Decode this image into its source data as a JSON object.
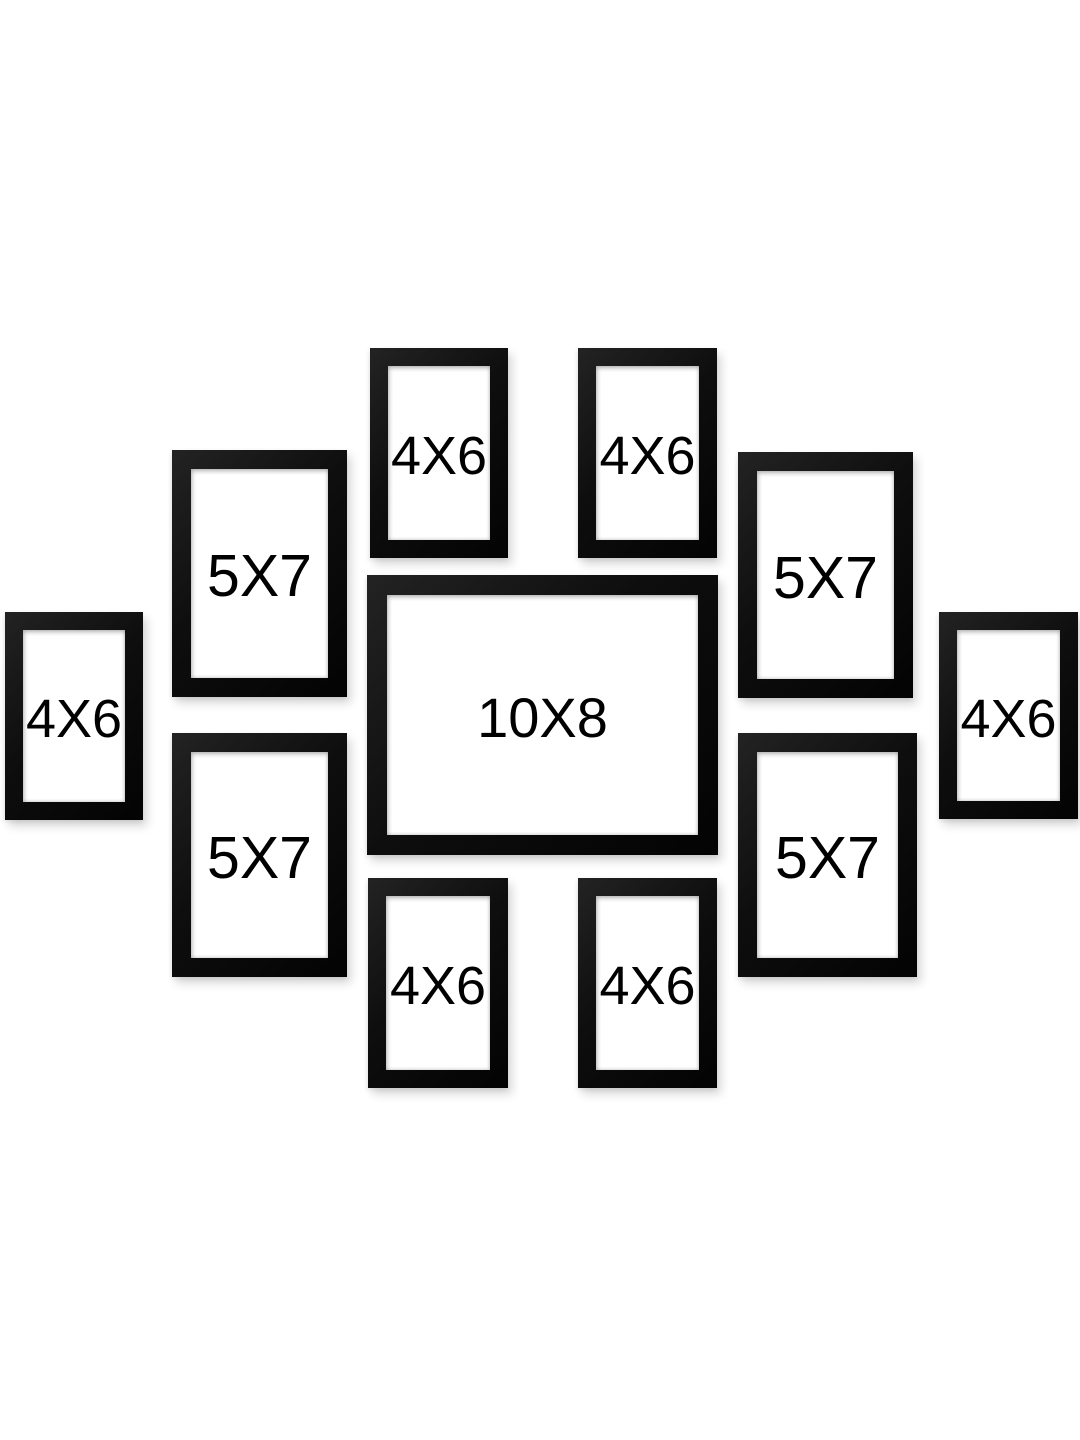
{
  "canvas": {
    "width": 1080,
    "height": 1440,
    "background": "#ffffff"
  },
  "colors": {
    "frame": "#0e0e0e",
    "frame_highlight": "#232323",
    "matte": "#ffffff",
    "label": "#000000"
  },
  "product": {
    "frame_count": 11,
    "sizes_shown": [
      "4X6",
      "5X7",
      "10X8"
    ]
  },
  "frames": [
    {
      "id": "top-left-4x6",
      "label": "4X6",
      "size": "4x6",
      "x": 370,
      "y": 348,
      "w": 138,
      "h": 210,
      "border": 18
    },
    {
      "id": "top-right-4x6",
      "label": "4X6",
      "size": "4x6",
      "x": 578,
      "y": 348,
      "w": 139,
      "h": 210,
      "border": 18
    },
    {
      "id": "left-upper-5x7",
      "label": "5X7",
      "size": "5x7",
      "x": 172,
      "y": 450,
      "w": 175,
      "h": 247,
      "border": 19
    },
    {
      "id": "right-upper-5x7",
      "label": "5X7",
      "size": "5x7",
      "x": 738,
      "y": 452,
      "w": 175,
      "h": 246,
      "border": 19
    },
    {
      "id": "center-10x8",
      "label": "10X8",
      "size": "10x8",
      "x": 367,
      "y": 575,
      "w": 351,
      "h": 280,
      "border": 20
    },
    {
      "id": "far-left-4x6",
      "label": "4X6",
      "size": "4x6",
      "x": 5,
      "y": 612,
      "w": 138,
      "h": 208,
      "border": 18
    },
    {
      "id": "far-right-4x6",
      "label": "4X6",
      "size": "4x6",
      "x": 939,
      "y": 612,
      "w": 139,
      "h": 207,
      "border": 18
    },
    {
      "id": "left-lower-5x7",
      "label": "5X7",
      "size": "5x7",
      "x": 172,
      "y": 733,
      "w": 175,
      "h": 244,
      "border": 19
    },
    {
      "id": "right-lower-5x7",
      "label": "5X7",
      "size": "5x7",
      "x": 738,
      "y": 733,
      "w": 179,
      "h": 244,
      "border": 19
    },
    {
      "id": "bottom-left-4x6",
      "label": "4X6",
      "size": "4x6",
      "x": 368,
      "y": 878,
      "w": 140,
      "h": 210,
      "border": 18
    },
    {
      "id": "bottom-right-4x6",
      "label": "4X6",
      "size": "4x6",
      "x": 578,
      "y": 878,
      "w": 139,
      "h": 210,
      "border": 18
    }
  ]
}
